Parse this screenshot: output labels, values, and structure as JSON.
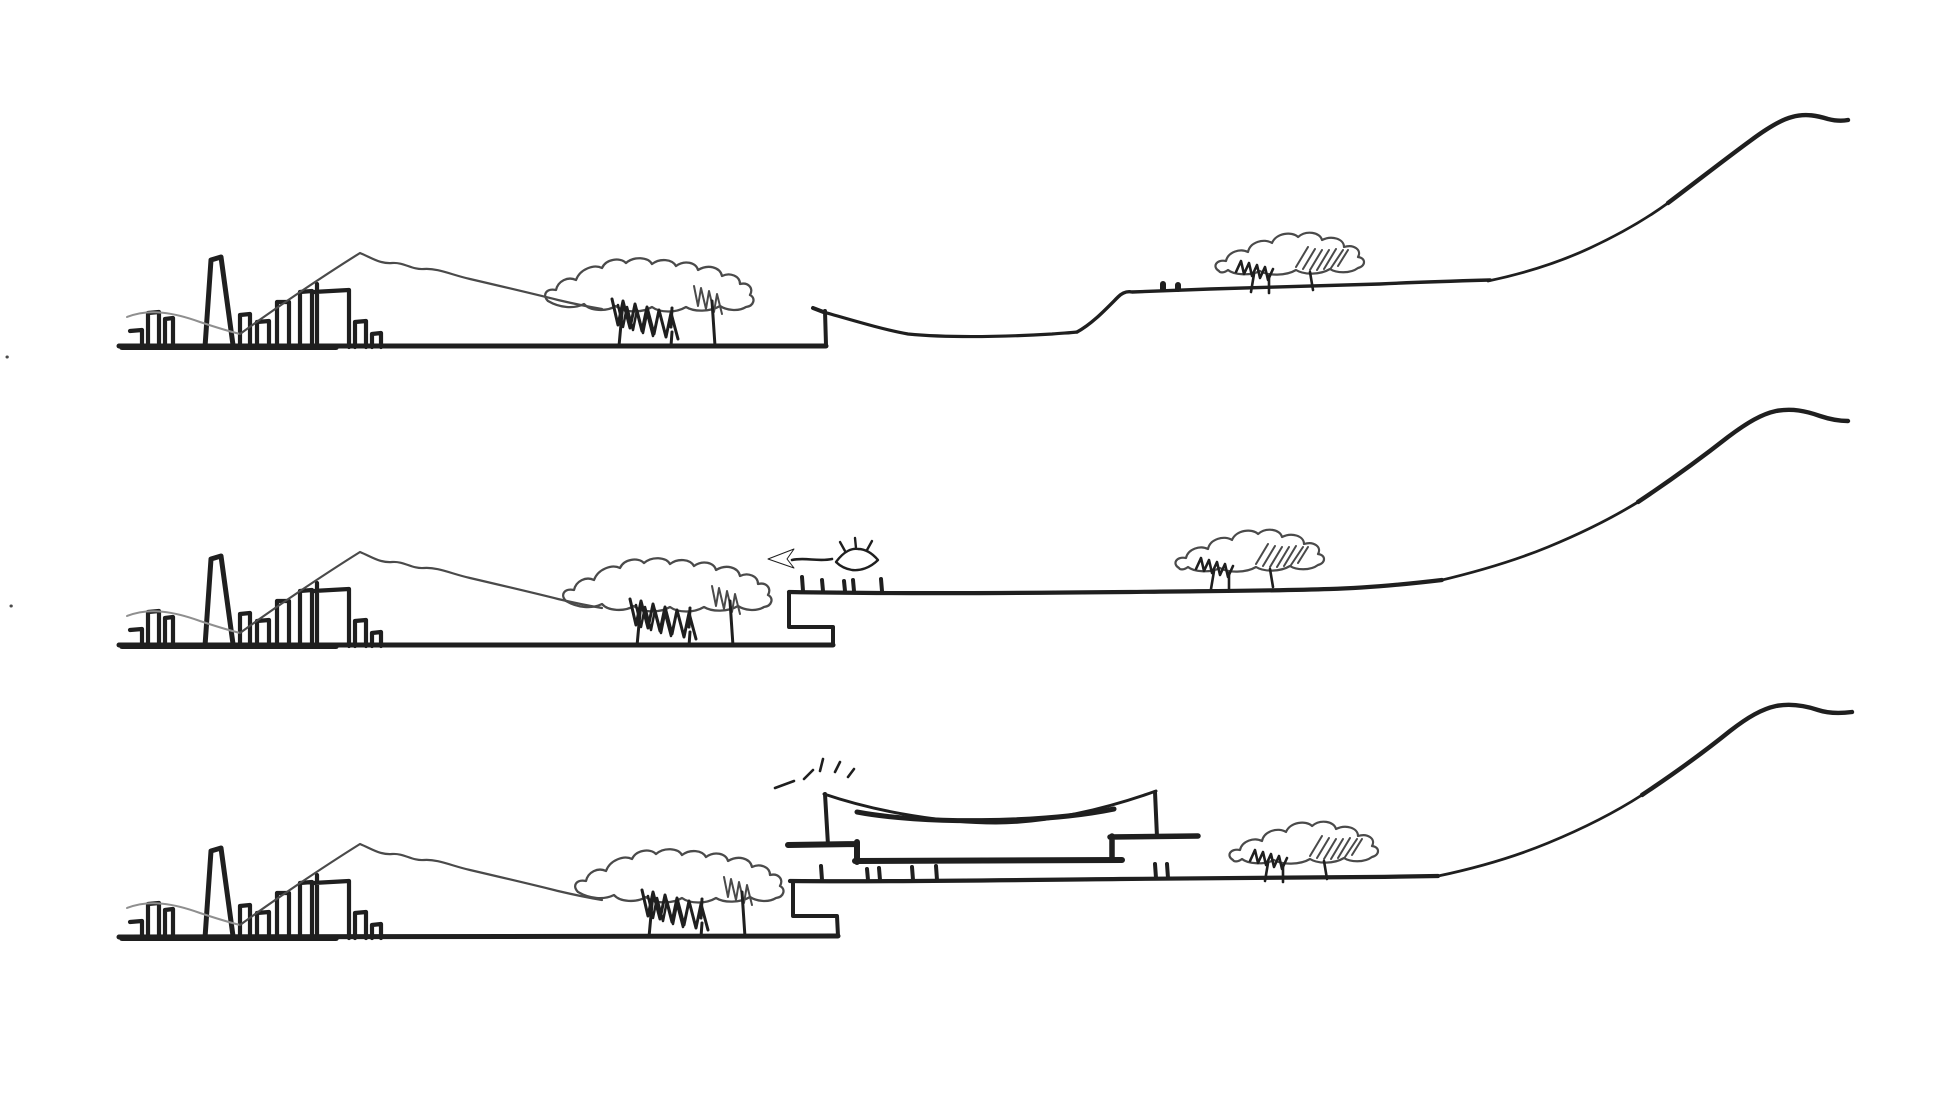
{
  "canvas": {
    "width": 1954,
    "height": 1100,
    "background": "#ffffff"
  },
  "palette": {
    "ink": "#1f1f1f",
    "soft": "#4a4a4a",
    "faint": "#8f8f8f",
    "hatch_dark": "#6e6e6e",
    "hatch_light": "#9b9b9b"
  },
  "motifs": {
    "city-skyline": [
      {
        "name": "city-base-line",
        "d": "M122,347 L336,347",
        "w": 6,
        "c": "ink"
      },
      {
        "name": "city-buildings-left",
        "d": "M130,331 L142,330 L142,347 M148,347 L148,313 L159,312 L159,347 M165,347 L165,319 L173,318 L173,347",
        "w": 4.2,
        "c": "ink"
      },
      {
        "name": "city-chimney",
        "d": "M205,347 L211,260 L221,257 L233,345",
        "w": 5,
        "c": "ink"
      },
      {
        "name": "city-buildings-mid",
        "d": "M240,347 L240,315 L250,314 L250,347 M257,347 L257,322 L269,321 L269,347 M277,347 L277,302 L289,302 L289,347",
        "w": 4.2,
        "c": "ink"
      },
      {
        "name": "city-buildings-right",
        "d": "M300,347 L300,292 L312,291 L312,347 M317,347 L317,284 M313,292 L349,290 L349,347 M355,347 L355,322 L366,321 L366,347 M372,347 L372,334 L381,333 L381,347",
        "w": 4.2,
        "c": "ink"
      }
    ],
    "mountain-ridge": [
      {
        "name": "ridge-foreline",
        "d": "M127,317 C150,308 175,313 200,322 C215,327 228,331 240,334",
        "w": 2,
        "c": "faint"
      },
      {
        "name": "ridge-peak-line",
        "d": "M240,334 C270,312 320,278 360,253 C372,258 380,264 392,263 C404,262 412,270 424,269 C438,268 452,275 470,279 C500,286 530,293 558,300 C575,304 590,307 602,309",
        "w": 2.2,
        "c": "soft"
      }
    ],
    "waterfront-trees": [
      {
        "name": "tree-canopy-outline",
        "d": "M548,301 C542,295 546,288 556,290 C558,281 568,276 576,280 C580,269 594,264 602,268 C606,259 620,257 626,263 C634,256 648,257 652,264 C660,258 672,259 676,266 C684,260 696,262 698,270 C708,264 720,267 722,276 C730,272 740,276 740,284 C748,282 754,288 750,295 C756,298 754,306 746,307 C738,312 726,310 720,306 C710,312 694,312 686,307 C676,313 660,313 652,307 C642,313 624,313 616,306 C606,312 590,311 584,304 C574,309 560,308 548,301 Z",
        "w": 2.3,
        "c": "soft"
      },
      {
        "name": "tree-scribble-dark",
        "d": "M612,299 l6,26 l5,-24 l7,27 l5,-24 l7,27 l5,-24 l7,27 l5,-24 l7,27 l5,-24 l7,26",
        "w": 3,
        "c": "ink"
      },
      {
        "name": "tree-scribble-dark-2",
        "d": "M618,305 l5,22 l4,-20 l6,23 l4,-20 l6,23 l4,-20 l6,23",
        "w": 2.5,
        "c": "ink"
      },
      {
        "name": "tree-scribble-light",
        "d": "M694,286 l4,20 l3,-18 l5,21 l3,-18 l5,21 l3,-18 l5,20",
        "w": 2,
        "c": "soft"
      },
      {
        "name": "tree-trunks",
        "d": "M623,302 L619,346 M672,308 L671,327 M672,332 L671,346 M712,301 L715,346",
        "w": 3,
        "c": "ink"
      }
    ],
    "hillside-trees": [
      {
        "name": "tree-canopy-outline",
        "d": "M1219,271 C1212,267 1216,259 1226,261 C1228,252 1240,248 1248,252 C1250,242 1264,238 1272,243 C1276,233 1292,231 1298,237 C1306,230 1320,232 1322,240 C1332,235 1344,239 1344,247 C1354,244 1362,250 1358,257 C1366,258 1366,266 1358,268 C1350,274 1336,273 1330,269 C1320,275 1304,275 1296,270 C1286,276 1268,276 1260,271 C1250,276 1234,275 1228,270 C1224,273 1220,273 1219,271 Z",
        "w": 2.2,
        "c": "soft"
      },
      {
        "name": "tree-hatch-diagonal",
        "d": "M1296,267 L1308,247 M1303,269 L1315,249 M1310,270 L1322,250 M1317,270 L1329,250 M1324,269 L1336,249 M1331,268 L1343,250 M1338,266 L1348,250",
        "w": 2,
        "c": "soft"
      },
      {
        "name": "tree-scribble-dark",
        "d": "M1236,272 l5,-11 l3,13 l5,-11 l3,13 l5,-11 l3,13 l5,-11 l3,13 l5,-11",
        "w": 2.6,
        "c": "ink"
      },
      {
        "name": "tree-trunks",
        "d": "M1254,274 L1251,292 M1269,276 L1269,293 M1310,272 L1313,290",
        "w": 2.6,
        "c": "ink"
      }
    ],
    "eye-icon": [
      {
        "name": "eye-outline",
        "d": "M836,562 C844,551 852,548 858,549 C866,549 872,553 878,560 C870,568 860,571 852,570 C846,569 840,566 836,562 Z",
        "w": 2.4,
        "c": "ink"
      },
      {
        "name": "eye-pupil",
        "d": "M851,560 a6,6 0 1,0 12,0 a6,6 0 1,0 -12,0 Z",
        "w": 0,
        "f": "ink"
      },
      {
        "name": "eye-lashes",
        "d": "M845,551 L840,542 M856,548 L855,538 M867,550 L872,541",
        "w": 2.4,
        "c": "ink"
      }
    ],
    "arrow-left-icon": [
      {
        "name": "arrow-shaft",
        "d": "M792,560 C805,557 818,562 832,559",
        "w": 2.6,
        "c": "ink"
      },
      {
        "name": "arrow-head",
        "d": "M768,559 L794,549 L787,559 L794,568 Z",
        "w": 1,
        "c": "ink",
        "f": "ink"
      }
    ],
    "sunburst-icon": [
      {
        "name": "sunburst-rays",
        "d": "M775,788 L794,781 M804,779 L813,770 M820,771 L823,759 M835,772 L840,762 M848,777 L854,769",
        "w": 2.6,
        "c": "ink"
      }
    ]
  },
  "panels": [
    {
      "name": "section-1-existing-site",
      "items": [
        {
          "motif": "city-skyline",
          "dx": 0,
          "dy": 0
        },
        {
          "motif": "mountain-ridge",
          "dx": 0,
          "dy": 0
        },
        {
          "motif": "waterfront-trees",
          "dx": 0,
          "dy": 0
        },
        {
          "motif": "hillside-trees",
          "dx": 0,
          "dy": 0
        }
      ],
      "strokes": [
        {
          "name": "ground-line",
          "d": "M119,346 L826,346",
          "w": 5,
          "c": "ink"
        },
        {
          "name": "quay-wall-edge",
          "d": "M826,345 L825,311 M826,313 L813,308",
          "w": 4,
          "c": "ink"
        },
        {
          "name": "valley-profile",
          "d": "M827,313 C855,321 885,330 908,334 C950,338 1000,337 1052,334 C1062,333 1070,333 1077,332",
          "w": 3.2,
          "c": "ink"
        },
        {
          "name": "upper-bench-profile",
          "d": "M1077,332 C1092,324 1106,309 1118,297 C1122,293 1127,291 1132,292 C1160,291 1180,290 1210,289 C1260,287 1320,286 1380,284 C1420,282 1455,281 1490,280",
          "w": 3.4,
          "c": "ink"
        },
        {
          "name": "bench-marker-dots",
          "d": "M1163,289 L1163,284 M1178,289 L1178,285",
          "w": 6,
          "c": "ink"
        },
        {
          "name": "hill-slope-lower",
          "d": "M1488,281 C1526,273 1560,262 1590,248 C1620,234 1646,219 1668,203",
          "w": 2.8,
          "c": "ink"
        },
        {
          "name": "hill-slope-upper",
          "d": "M1668,203 C1696,182 1724,160 1750,141 C1766,129 1780,120 1792,117 C1806,113 1818,116 1828,119 C1836,121 1843,121 1848,120",
          "w": 4.4,
          "c": "ink"
        },
        {
          "name": "paper-speck-dots",
          "d": "M7,357 l0.3,0 M11,606 l0.3,0",
          "w": 3,
          "c": "soft"
        }
      ]
    },
    {
      "name": "section-2-view-from-edge",
      "items": [
        {
          "motif": "city-skyline",
          "dx": 0,
          "dy": 299
        },
        {
          "motif": "mountain-ridge",
          "dx": 0,
          "dy": 299
        },
        {
          "motif": "waterfront-trees",
          "dx": 18,
          "dy": 300
        },
        {
          "motif": "hillside-trees",
          "dx": -40,
          "dy": 297
        },
        {
          "motif": "eye-icon",
          "dx": 0,
          "dy": 0
        },
        {
          "motif": "arrow-left-icon",
          "dx": 0,
          "dy": 0
        }
      ],
      "strokes": [
        {
          "name": "ground-line",
          "d": "M119,645 L833,645",
          "w": 5,
          "c": "ink"
        },
        {
          "name": "quay-step-profile",
          "d": "M833,645 L833,627 L789,627 L789,593",
          "w": 4,
          "c": "ink"
        },
        {
          "name": "deck-line",
          "d": "M789,592 C900,594 1020,593 1130,592 C1200,591 1270,591 1330,589 C1370,588 1408,584 1442,580",
          "w": 4.2,
          "c": "ink"
        },
        {
          "name": "deck-bollards",
          "d": "M803,591 L802,577 M823,591 L822,580 M845,591 L844,581 M854,591 L853,580 M882,591 L881,579",
          "w": 4,
          "c": "ink"
        },
        {
          "name": "hill-slope-lower",
          "d": "M1438,581 C1476,572 1514,561 1548,547 C1582,533 1612,518 1638,502",
          "w": 2.8,
          "c": "ink"
        },
        {
          "name": "hill-slope-upper",
          "d": "M1638,502 C1668,482 1700,459 1728,437 C1748,422 1762,414 1776,411 C1792,408 1806,411 1820,416 C1832,420 1842,421 1848,421",
          "w": 4.4,
          "c": "ink"
        }
      ]
    },
    {
      "name": "section-3-proposed-pavilion",
      "items": [
        {
          "motif": "city-skyline",
          "dx": 0,
          "dy": 591
        },
        {
          "motif": "mountain-ridge",
          "dx": 0,
          "dy": 591
        },
        {
          "motif": "waterfront-trees",
          "dx": 30,
          "dy": 591
        },
        {
          "motif": "hillside-trees",
          "dx": 14,
          "dy": 589
        },
        {
          "motif": "sunburst-icon",
          "dx": 0,
          "dy": 0
        }
      ],
      "strokes": [
        {
          "name": "ground-line",
          "d": "M119,937 L838,936",
          "w": 5,
          "c": "ink"
        },
        {
          "name": "quay-step-profile",
          "d": "M838,936 L837,916 L793,916 L793,882",
          "w": 4,
          "c": "ink"
        },
        {
          "name": "deck-line",
          "d": "M790,881 C900,882 1010,880 1120,879 C1220,878 1330,878 1438,876",
          "w": 4.2,
          "c": "ink"
        },
        {
          "name": "deck-bollards",
          "d": "M822,880 L821,866 M868,880 L867,869 M880,880 L879,868 M913,880 L912,867 M937,880 L936,866 M1156,878 L1155,864 M1168,878 L1167,864",
          "w": 4,
          "c": "ink"
        },
        {
          "name": "pavilion-roof-hatch",
          "d": "M826,795 C880,813 946,822 996,822 C1046,822 1104,809 1154,792 L1157,836 L1112,836 L1112,858 L857,858 L857,844 L828,844 Z",
          "w": 0,
          "f": "hatch"
        },
        {
          "name": "pavilion-roof-top-edge",
          "d": "M824,794 C880,813 946,823 996,823 C1046,823 1106,809 1156,791",
          "w": 3,
          "c": "ink"
        },
        {
          "name": "pavilion-left-wall",
          "d": "M825,794 L828,845",
          "w": 4,
          "c": "ink"
        },
        {
          "name": "pavilion-right-wall",
          "d": "M1155,792 L1157,837",
          "w": 4,
          "c": "ink"
        },
        {
          "name": "pavilion-soffit-curve",
          "d": "M857,812 C920,824 1040,824 1114,809",
          "w": 5,
          "c": "ink"
        },
        {
          "name": "pavilion-base-slab",
          "d": "M855,861 L1122,860",
          "w": 6,
          "c": "ink"
        },
        {
          "name": "platform-slab-left",
          "d": "M788,845 L856,844 M857,842 L857,862",
          "w": 6,
          "c": "ink"
        },
        {
          "name": "platform-slab-right",
          "d": "M1110,837 L1198,836 M1112,836 L1112,858",
          "w": 5.5,
          "c": "ink"
        },
        {
          "name": "hill-slope-lower",
          "d": "M1438,876 C1476,868 1514,857 1548,843 C1582,829 1614,813 1642,795",
          "w": 2.8,
          "c": "ink"
        },
        {
          "name": "hill-slope-upper",
          "d": "M1642,795 C1672,775 1704,752 1730,731 C1748,717 1762,709 1776,706 C1792,703 1806,706 1818,710 C1830,714 1844,713 1852,712",
          "w": 4.4,
          "c": "ink"
        }
      ]
    }
  ]
}
